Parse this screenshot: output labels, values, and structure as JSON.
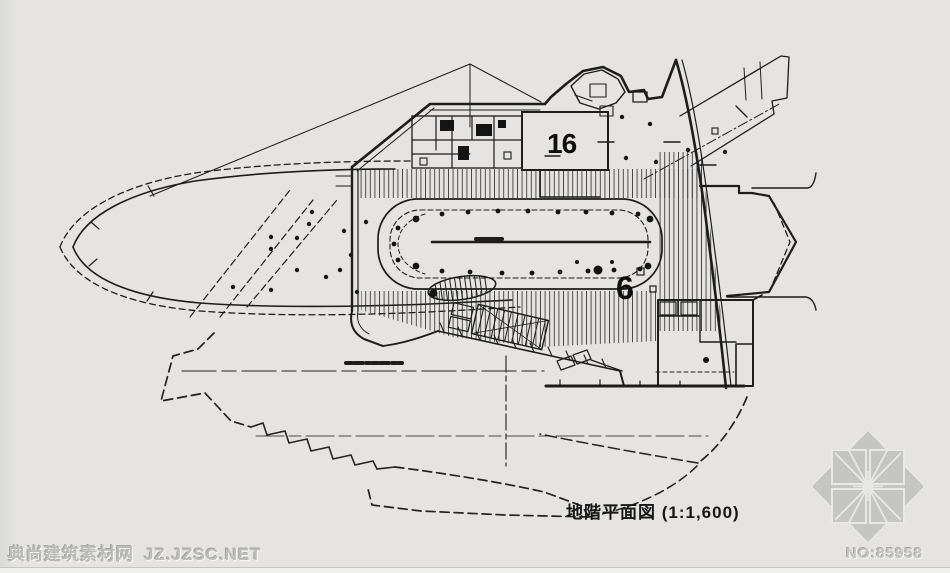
{
  "page": {
    "background_color": "#e5e4e2",
    "ink_color": "#1d1d1d"
  },
  "drawing": {
    "caption": "地階平面図 (1:1,600)",
    "room_label_large": "16",
    "room_label_small": "6"
  },
  "watermark": {
    "site_name": "典尚建筑素材网",
    "site_code": "JZ.JZSC.NET",
    "item_number": "NO:85958",
    "logo_icon": "jzsc-compass-logo",
    "text_color": "#bcbcba"
  }
}
